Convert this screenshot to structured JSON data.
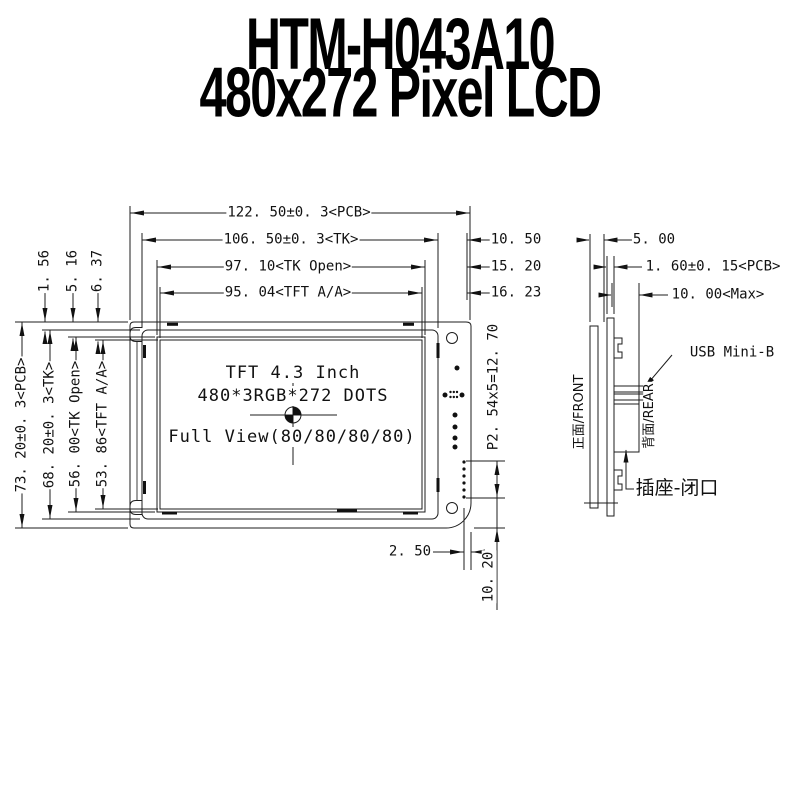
{
  "title": {
    "line1": "HTM-H043A10",
    "line2": "480x272 Pixel LCD"
  },
  "front": {
    "screen": {
      "line1": "TFT 4.3 Inch",
      "line2": "480*3RGB*272 DOTS",
      "line3": "Full View(80/80/80/80)"
    },
    "dims": {
      "w_pcb": "122. 50±0. 3<PCB>",
      "w_tk": "106. 50±0. 3<TK>",
      "w_tk_open": "97. 10<TK Open>",
      "w_tft": "95. 04<TFT A/A>",
      "r1": "10. 50",
      "r2": "15. 20",
      "r3": "16. 23",
      "h_pcb": "73. 20±0. 3<PCB>",
      "h_tk": "68. 20±0. 3<TK>",
      "h_tk_open": "56. 00<TK Open>",
      "h_tft": "53. 86<TFT A/A>",
      "o1": "1. 56",
      "o2": "5. 16",
      "o3": "6. 37",
      "bottom": "2. 50",
      "bottom_right": "10. 20",
      "pin_pitch": "P2. 54x5=12. 70"
    }
  },
  "side": {
    "dims": {
      "thickness": "5. 00",
      "pcb": "1. 60±0. 15<PCB>",
      "max": "10. 00<Max>"
    },
    "labels": {
      "usb": "USB Mini-B",
      "socket": "插座-闭口",
      "front": "正面/FRONT",
      "rear": "背面/REAR"
    }
  }
}
